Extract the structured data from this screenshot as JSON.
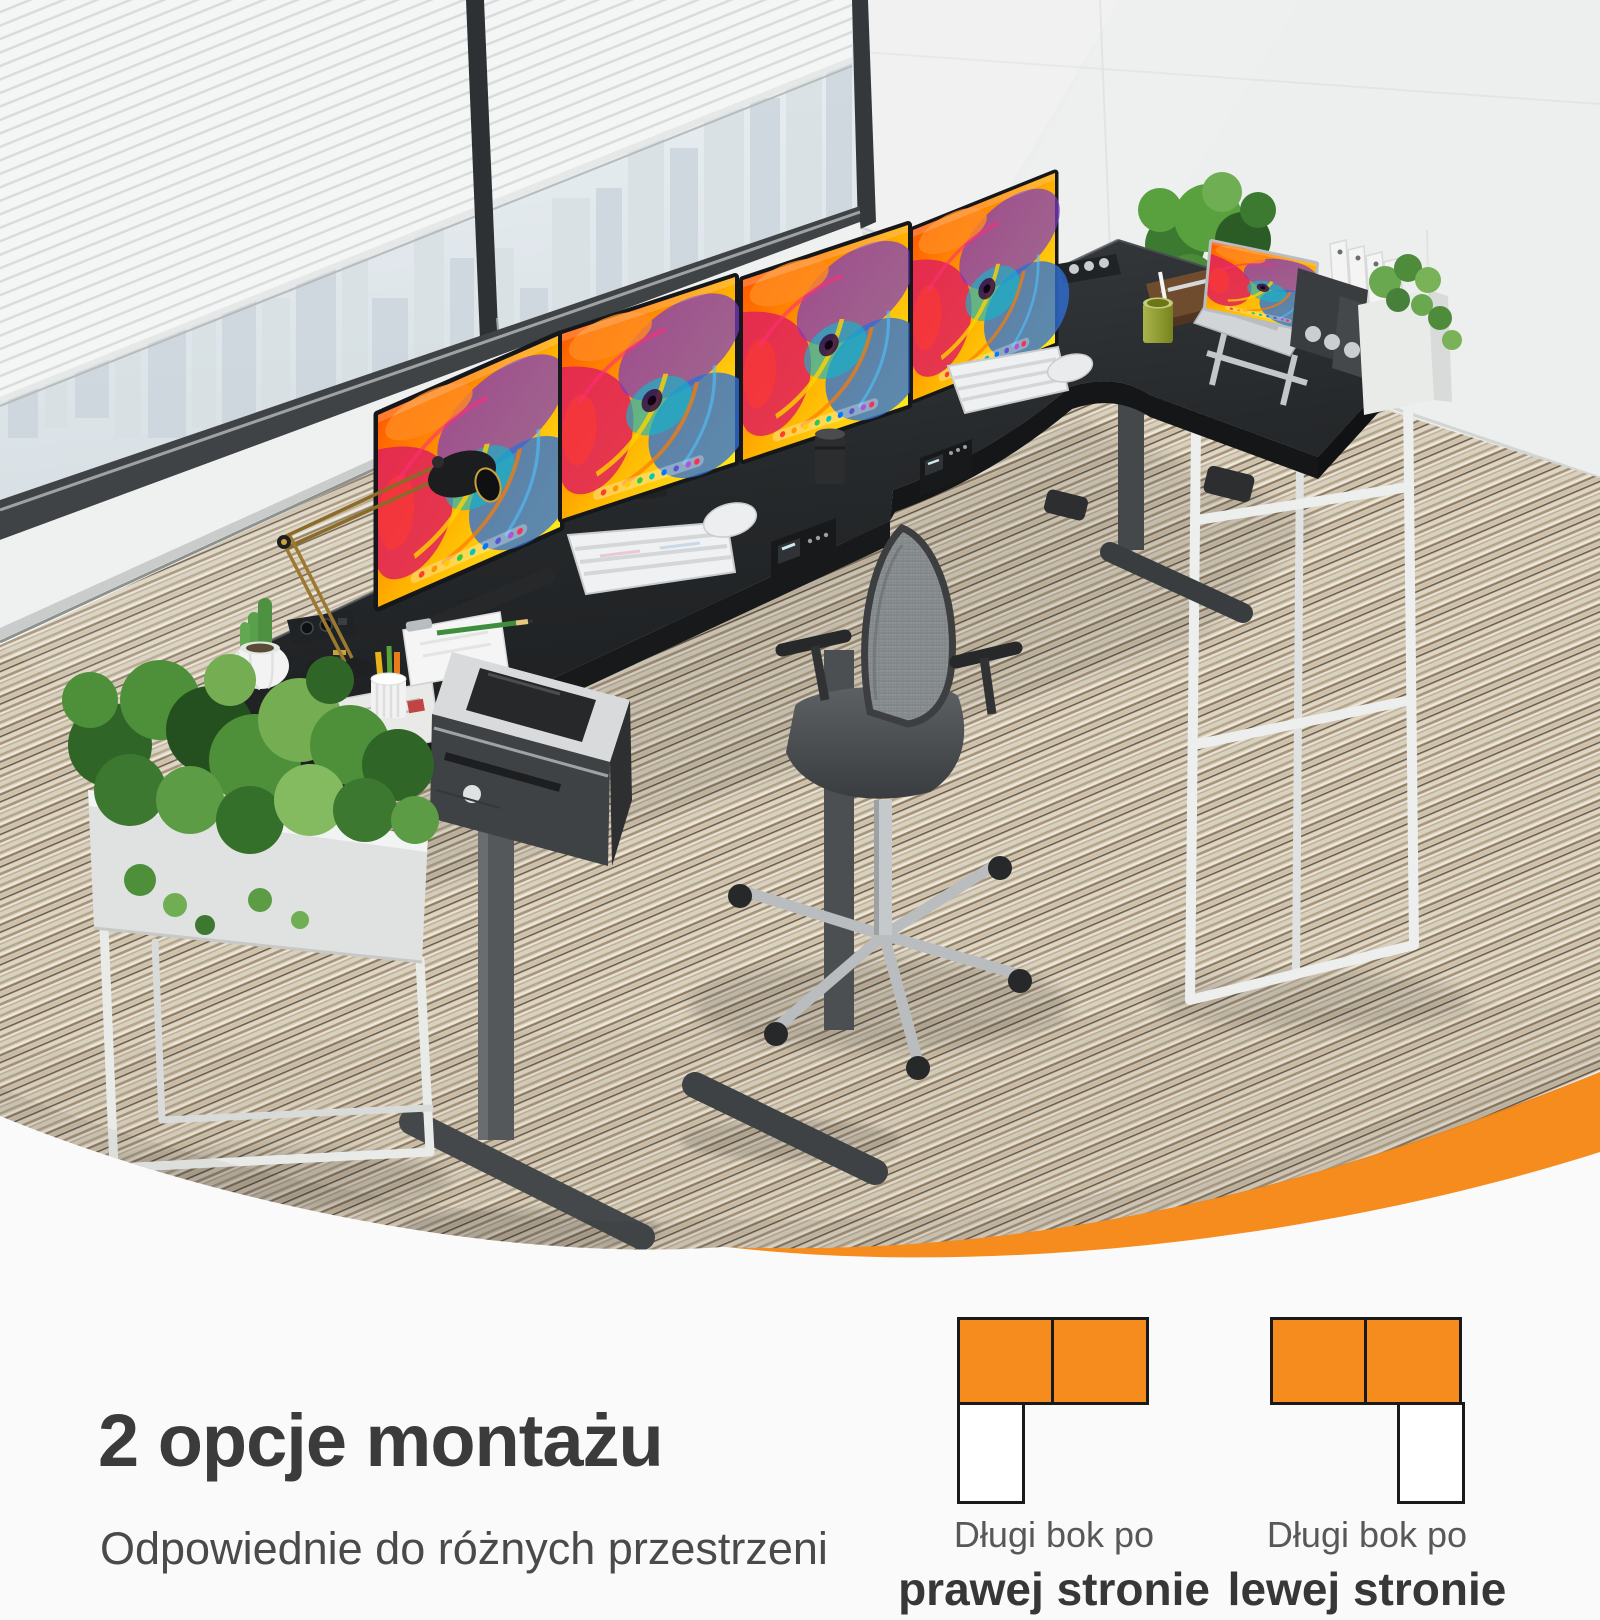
{
  "colors": {
    "accent": "#f68b1e",
    "background": "#fafafa",
    "heading_text": "#3b3b3b",
    "subtitle_text": "#4a4a4a",
    "diagram_label": "#585858",
    "diagram_label_bold": "#373737",
    "diagram_border": "#1a1a1a",
    "diagram_cell_white": "#ffffff"
  },
  "caption": {
    "heading": "2 opcje montażu",
    "subtitle": "Odpowiednie do różnych przestrzeni"
  },
  "options": [
    {
      "id": "long-side-right",
      "label_line1": "Długi bok po",
      "label_line2": "prawej stronie",
      "orange_cells": 2,
      "white_cell_position": "bottom-left"
    },
    {
      "id": "long-side-left",
      "label_line1": "Długi bok po",
      "label_line2": "lewej stronie",
      "orange_cells": 2,
      "white_cell_position": "bottom-right"
    }
  ],
  "scene": {
    "type": "office product photo",
    "desk_shape": "L",
    "desk_color": "black",
    "monitor_count": 4,
    "keyboard_count": 2,
    "has_laptop": true,
    "has_office_chair": true,
    "has_printer": true,
    "planters": 3,
    "window_view": "city skyline",
    "floor": "striped beige carpet"
  }
}
